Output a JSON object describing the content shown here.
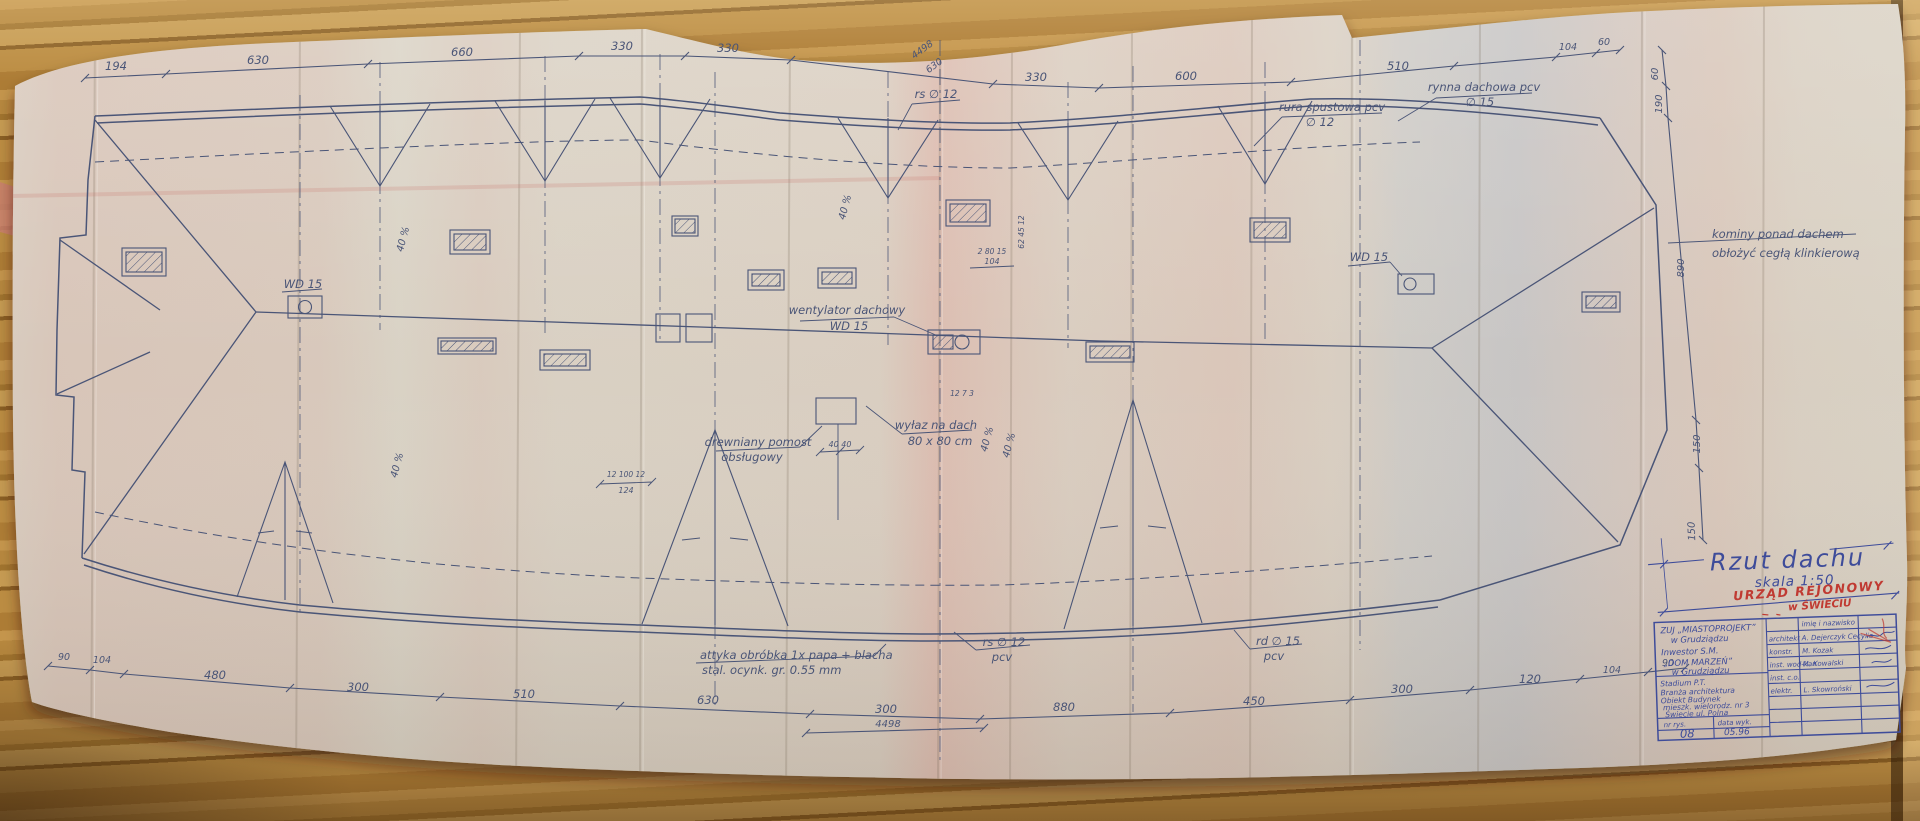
{
  "labels": {
    "rs_top": "rs ∅ 12",
    "rura_1": "rura spustowa pcv",
    "rura_2": "∅ 12",
    "rynna_1": "rynna dachowa pcv",
    "rynna_2": "∅ 15",
    "kominy_1": "kominy ponad dachem",
    "kominy_2": "obłożyć cegłą klinkierową",
    "went_1": "wentylator dachowy",
    "went_2": "WD 15",
    "wd_left": "WD 15",
    "wd_right": "WD 15",
    "wylaz_1": "wyłaz na dach",
    "wylaz_2": "80 x 80 cm",
    "pomost_1": "drewniany pomost",
    "pomost_2": "obsługowy",
    "attyka_1": "attyka  obróbka  1x papa + blacha",
    "attyka_2": "stal. ocynk.  gr. 0.55 mm",
    "rs_bot_1": "rs ∅ 12",
    "rs_bot_2": "pcv",
    "rd_bot_1": "rd ∅ 15",
    "rd_bot_2": "pcv",
    "slope": "40 %"
  },
  "dims": {
    "top": [
      "194",
      "630",
      "660",
      "330",
      "330",
      "330",
      "600",
      "510",
      "104",
      "60"
    ],
    "top_total": "4498",
    "top_fold": "630",
    "bottom": [
      "90",
      "104",
      "480",
      "300",
      "510",
      "630",
      "300",
      "880",
      "450",
      "300",
      "120",
      "104",
      "90"
    ],
    "bottom_total": "4498",
    "right": [
      "60",
      "190",
      "890",
      "150"
    ],
    "small": {
      "s40": "40  40",
      "s12x": "12 100 12",
      "s124": "124",
      "s2805": "2 80 15",
      "s104": "104",
      "s273": "12  7  3",
      "s6245": "62 45 12"
    }
  },
  "title_block": {
    "title": "Rzut  dachu",
    "scale": "skala  1:50",
    "stamp1": "URZĄD REJONOWY",
    "stamp2": "w ŚWIECIU",
    "firm1": "ZUJ „MIASTOPROJEKT”",
    "firm2": "w Grudziądzu",
    "firm3": "Inwestor    S.M.",
    "firm4": "„DOM MARZEŃ”",
    "firm5": "w Grudziądzu",
    "proj1": "Stadium      P.T.",
    "proj2": "Branża   architektura",
    "proj3": "Obiekt   Budynek",
    "proj4": "mieszk. wielorodz. nr 3",
    "proj5": "Świecie ul. Polna",
    "nr_label": "nr rys.",
    "date_label": "data wyk.",
    "nr_value": "08",
    "date_value": "05.96",
    "names_header": "imię i nazwisko",
    "roles": [
      {
        "role": "architekt",
        "name": "A. Dejerczyk Cecylia"
      },
      {
        "role": "konstr.",
        "name": "M. Kozak"
      },
      {
        "role": "inst. wod-kan",
        "name": "M. Kowalski"
      },
      {
        "role": "inst. c.o.",
        "name": ""
      },
      {
        "role": "elektr.",
        "name": "L. Skowroński"
      }
    ]
  }
}
